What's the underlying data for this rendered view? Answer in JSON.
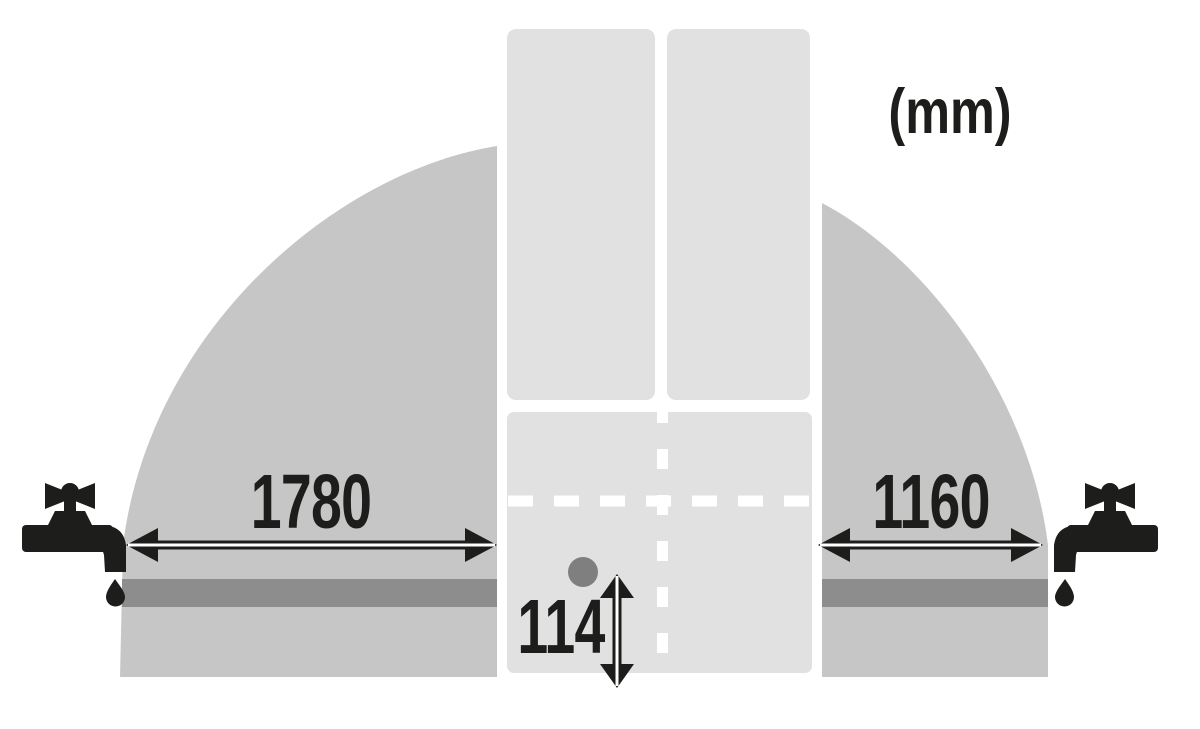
{
  "diagram": {
    "unit_label": "(mm)",
    "measurements": {
      "left_reach": "1780",
      "right_reach": "1160",
      "bottom_clearance": "114"
    }
  },
  "colors": {
    "background": "#ffffff",
    "reach_area": "#c6c6c6",
    "appliance_panel": "#e1e1e1",
    "hose_bar": "#8d8d8d",
    "connection_dot": "#7f7f7f",
    "ink": "#1d1d1b",
    "outline_white": "#ffffff"
  },
  "icons": {
    "left_tap": "water-tap-icon",
    "right_tap": "water-tap-icon",
    "left_arrow": "double-arrow-horizontal-icon",
    "right_arrow": "double-arrow-horizontal-icon",
    "vertical_arrow": "double-arrow-vertical-icon"
  }
}
